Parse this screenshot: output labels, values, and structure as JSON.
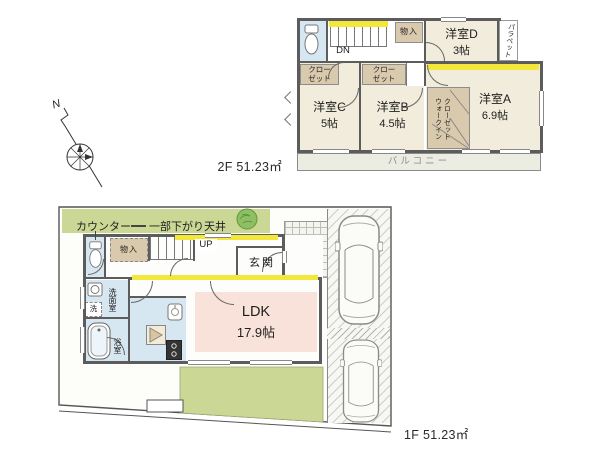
{
  "colors": {
    "cream": "#f1ecdb",
    "tan": "#d9c9ad",
    "blue": "#d7e7f1",
    "pink": "#f8e2d9",
    "green": "#cbd795",
    "yellow": "#f4e73b",
    "balcony": "#ebece2",
    "wall": "#5c5c5c",
    "text": "#1f1f1f",
    "gray_text": "#8f8f8f"
  },
  "plan2f": {
    "area_label": "2F 51.23㎡",
    "rooms": {
      "d": {
        "name": "洋室D",
        "size": "3帖"
      },
      "c": {
        "name": "洋室C",
        "size": "5帖"
      },
      "b": {
        "name": "洋室B",
        "size": "4.5帖"
      },
      "a": {
        "name": "洋室A",
        "size": "6.9帖"
      }
    },
    "labels": {
      "storage": "物入",
      "closet": "クロー\nゼット",
      "wic_col1": "ウォークイン",
      "wic_col2": "クローゼット",
      "parapet": "パラペット",
      "balcony": "バルコニー",
      "stairs_down": "DN"
    }
  },
  "plan1f": {
    "area_label": "1F 51.23㎡",
    "ldk": {
      "name": "LDK",
      "size": "17.9帖"
    },
    "labels": {
      "counter_note": "カウンター",
      "ceiling_note": "一部下がり天井",
      "entrance": "玄関",
      "storage": "物入",
      "stairs_up": "UP",
      "washroom": "洗面室",
      "washer": "洗",
      "bathroom": "浴室",
      "north": "N"
    }
  }
}
